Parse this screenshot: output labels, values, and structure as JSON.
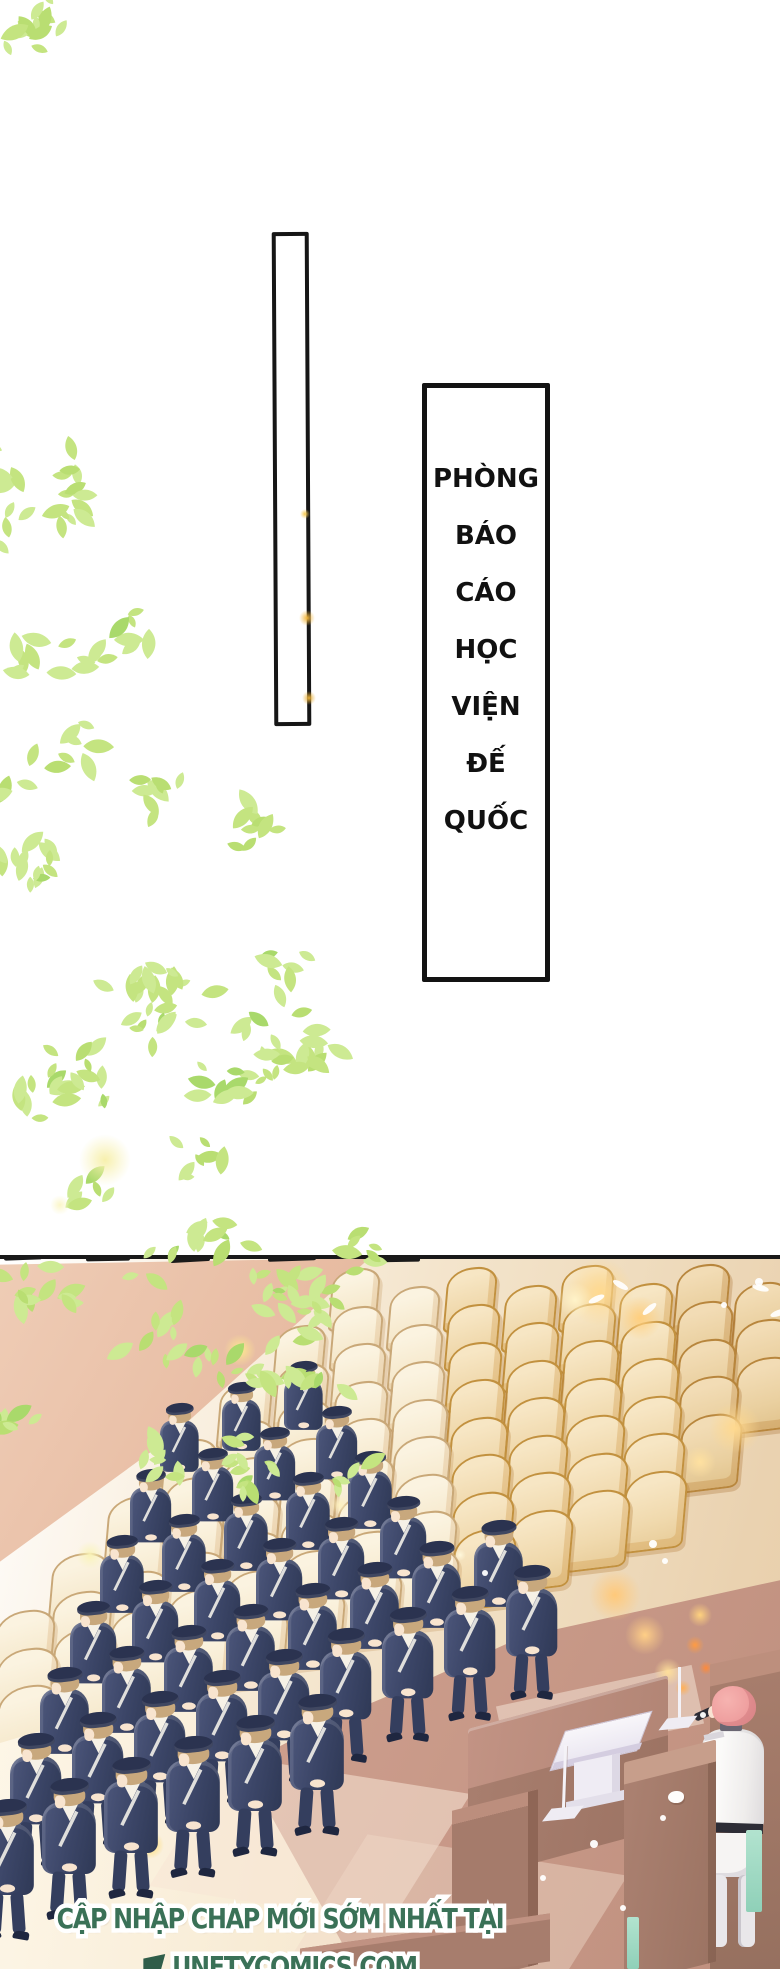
{
  "panels": {
    "empty_rect": {
      "border_color": "#161616"
    },
    "speech_box": {
      "border_color": "#131313",
      "lines": [
        "PHÒNG",
        "BÁO",
        "CÁO",
        "HỌC",
        "VIỆN",
        "ĐẾ",
        "QUỐC"
      ]
    }
  },
  "caption": {
    "line1": "CẬP NHẬP CHAP MỚI SỚM NHẤT TẠI",
    "line2": "UNETYCOMICS.COM",
    "text_color": "#3a7157",
    "outline_color": "#ffffff"
  },
  "foliage": {
    "colors": [
      "#cdea93",
      "#c4e480",
      "#b9de72",
      "#a9d96b"
    ],
    "clusters": [
      {
        "x": 0,
        "y": 0,
        "w": 70,
        "h": 58,
        "n": 12,
        "bias": 1.6,
        "seed": 11
      },
      {
        "x": 0,
        "y": 455,
        "w": 160,
        "h": 260,
        "n": 26,
        "bias": 1.8,
        "seed": 22
      },
      {
        "x": 0,
        "y": 610,
        "w": 340,
        "h": 500,
        "n": 120,
        "bias": 1.5,
        "seed": 33
      },
      {
        "x": 0,
        "y": 1050,
        "w": 310,
        "h": 230,
        "n": 55,
        "bias": 1.4,
        "seed": 44
      },
      {
        "x": 0,
        "y": 1248,
        "w": 460,
        "h": 245,
        "n": 80,
        "bias": 1.3,
        "seed": 55
      },
      {
        "x": 248,
        "y": 1295,
        "w": 190,
        "h": 205,
        "n": 32,
        "bias": 0.9,
        "seed": 66
      }
    ]
  },
  "scene": {
    "top": 1255,
    "colors": {
      "line": "#191919",
      "chair_cream": "#f8eed9",
      "chair_warm": "#f0d9ad",
      "wall_pink": "#e6b89e",
      "floor_rose": "#cb9c8b",
      "uniform_navy": "#3c4668",
      "beret_navy": "#2b3350",
      "hair_brown": "#c8a87d",
      "speaker_hair_pink": "#ee9e9e",
      "speaker_uniform": "#f8f6f4",
      "desk_brown": "#a87e6e",
      "lectern_white": "#f4f2f7",
      "mint": "#a5dbc6"
    },
    "chair_grid": {
      "rows": 9,
      "x0": 330,
      "y0": 14,
      "row_dx": -56,
      "row_dy": 57,
      "step_dx": 57,
      "step_dy": -19.5,
      "count": 14
    },
    "soldier_grid": {
      "baseX": 160,
      "baseY": 148,
      "row_dx": -30,
      "row_dy": 66,
      "col_dx": 62,
      "col_dy": -21,
      "counts": [
        3,
        4,
        5,
        6,
        8,
        9,
        6
      ],
      "legs_from": 5
    },
    "sketch_strokes": [
      [
        4,
        -4,
        38,
        5,
        -2
      ],
      [
        40,
        -6,
        30,
        4,
        3
      ],
      [
        86,
        -3,
        44,
        5,
        -1
      ],
      [
        140,
        -6,
        26,
        4,
        2
      ],
      [
        170,
        -2,
        40,
        5,
        -3
      ],
      [
        225,
        -5,
        34,
        4,
        1
      ],
      [
        268,
        -3,
        48,
        5,
        -2
      ],
      [
        330,
        -6,
        30,
        4,
        2
      ],
      [
        368,
        -2,
        52,
        5,
        -1
      ],
      [
        200,
        -8,
        18,
        3,
        4
      ]
    ],
    "glows": [
      [
        600,
        37,
        34,
        "#ffd98f"
      ],
      [
        640,
        63,
        22,
        "#ffcf7e"
      ],
      [
        575,
        45,
        18,
        "#fff3c9"
      ],
      [
        735,
        173,
        26,
        "#ffd98f"
      ],
      [
        700,
        207,
        16,
        "#ffe1a0"
      ],
      [
        615,
        340,
        26,
        "#ffc97a"
      ],
      [
        645,
        380,
        20,
        "#ffcf86"
      ],
      [
        668,
        417,
        14,
        "#ffdf9a"
      ],
      [
        695,
        390,
        9,
        "#ff9b42"
      ],
      [
        706,
        413,
        7,
        "#ff8a3a"
      ],
      [
        683,
        433,
        8,
        "#ffb057"
      ],
      [
        700,
        360,
        12,
        "#ffd27e"
      ],
      [
        185,
        535,
        20,
        "#ffe469"
      ],
      [
        150,
        590,
        14,
        "#ffd95e"
      ],
      [
        240,
        95,
        16,
        "#ffe98f"
      ],
      [
        340,
        250,
        10,
        "#fff2c0"
      ],
      [
        90,
        300,
        14,
        "#f9f3b8"
      ],
      [
        460,
        300,
        6,
        "#fff8dc"
      ]
    ],
    "white_dots": [
      [
        649,
        285,
        4
      ],
      [
        662,
        303,
        3
      ],
      [
        721,
        47,
        3
      ],
      [
        755,
        23,
        4
      ],
      [
        700,
        457,
        3
      ],
      [
        590,
        585,
        4
      ],
      [
        620,
        650,
        3
      ],
      [
        482,
        315,
        3
      ],
      [
        540,
        620,
        3
      ],
      [
        660,
        560,
        3
      ]
    ],
    "petals": [
      [
        588,
        41,
        -25
      ],
      [
        612,
        27,
        30
      ],
      [
        641,
        51,
        -40
      ],
      [
        752,
        30,
        15
      ],
      [
        770,
        55,
        -20
      ]
    ],
    "mint_bars": [
      [
        746,
        575,
        16,
        82
      ],
      [
        627,
        662,
        12,
        52
      ]
    ]
  },
  "page_sparkles": [
    [
      307,
      618,
      8,
      "#f2b63c"
    ],
    [
      309,
      698,
      7,
      "#eab037"
    ],
    [
      305,
      514,
      5,
      "#f4c84f"
    ],
    [
      105,
      1160,
      26,
      "#f7f0ad"
    ],
    [
      60,
      1205,
      10,
      "#fbf6c8"
    ]
  ]
}
